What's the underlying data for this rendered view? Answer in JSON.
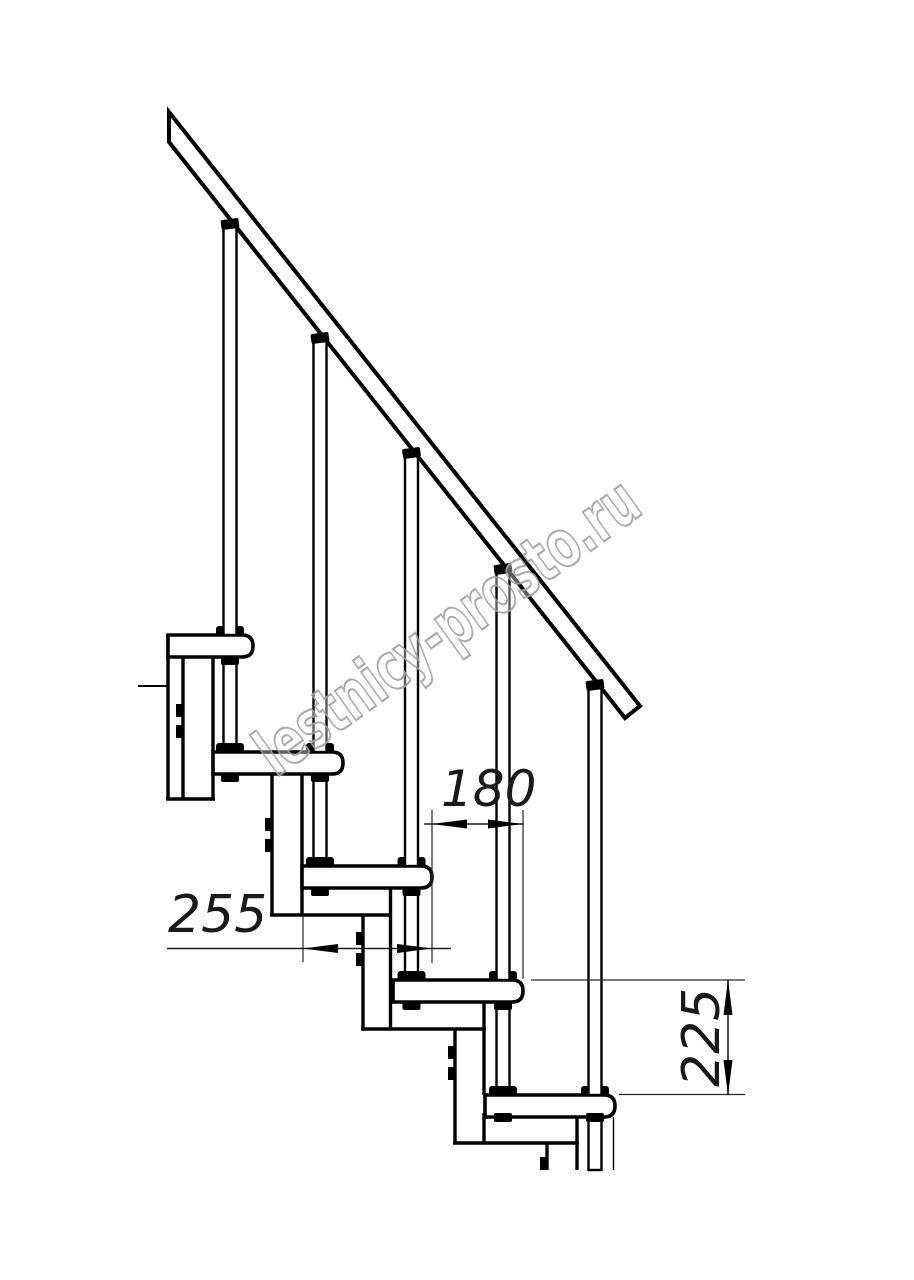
{
  "page": {
    "background": "#ffffff",
    "line_color": "#000000"
  },
  "watermark": {
    "text": "lestnicy-prosto.ru",
    "outline_color": "#a2a2a2"
  },
  "dimensions": {
    "d180": {
      "value": "180"
    },
    "d255": {
      "value": "255"
    },
    "d225": {
      "value": "225"
    }
  }
}
